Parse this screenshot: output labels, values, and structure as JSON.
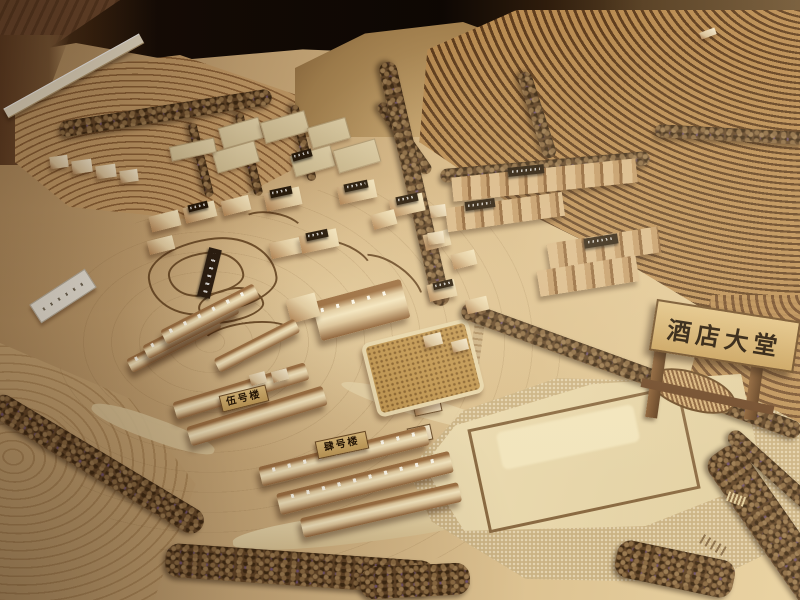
{
  "scene": {
    "description": "photograph of a wooden architectural scale model of a hillside resort with terraced slopes, tree rows, building clusters and labeled plaques",
    "signs": {
      "hotel_lobby": "酒店大堂",
      "building_5": "伍号楼",
      "building_4": "肆号楼"
    },
    "palette": {
      "backdrop_dark": "#0d0703",
      "table_wood": "#66422a",
      "terrain_tan": "#c9a875",
      "terrace_dark": "#5f3d1d",
      "building_wood": "#e6d2a8",
      "building_shadow": "#a87c4a",
      "plaque_dark": "#241708",
      "plaque_tan": "#c9a35e",
      "sign_text": "#241505",
      "tree_brown": "#5f4326",
      "plaza_pale": "#e9dab2"
    }
  }
}
